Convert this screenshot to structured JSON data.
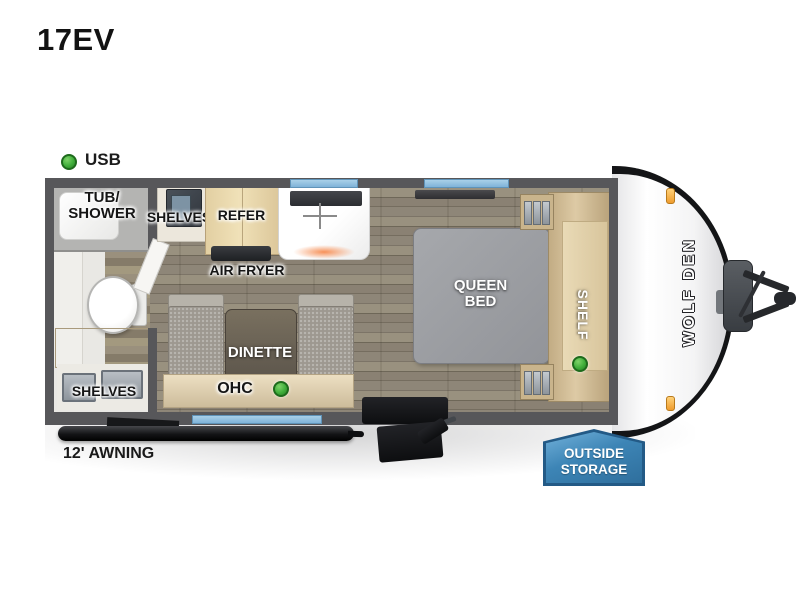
{
  "title": "17EV",
  "legend": {
    "usb": "USB"
  },
  "plan": {
    "tub_line1": "TUB/",
    "tub_line2": "SHOWER",
    "bath_shelves": "SHELVES",
    "kitchen_shelves": "SHELVES",
    "refer": "REFER",
    "air_fryer": "AIR FRYER",
    "dinette": "DINETTE",
    "ohc": "OHC",
    "queen_line1": "QUEEN",
    "queen_line2": "BED",
    "shelf": "SHELF"
  },
  "exterior": {
    "awning": "12' AWNING",
    "badge_line1": "OUTSIDE",
    "badge_line2": "STORAGE",
    "brand": "WOLF DEN"
  },
  "colors": {
    "usb_dot_green": "#3fae3a",
    "window_blue": "#8abcdd",
    "badge_blue": "#3d85b6",
    "wall_gray": "#57575a",
    "marker_light_orange": "#ef9c2e"
  }
}
